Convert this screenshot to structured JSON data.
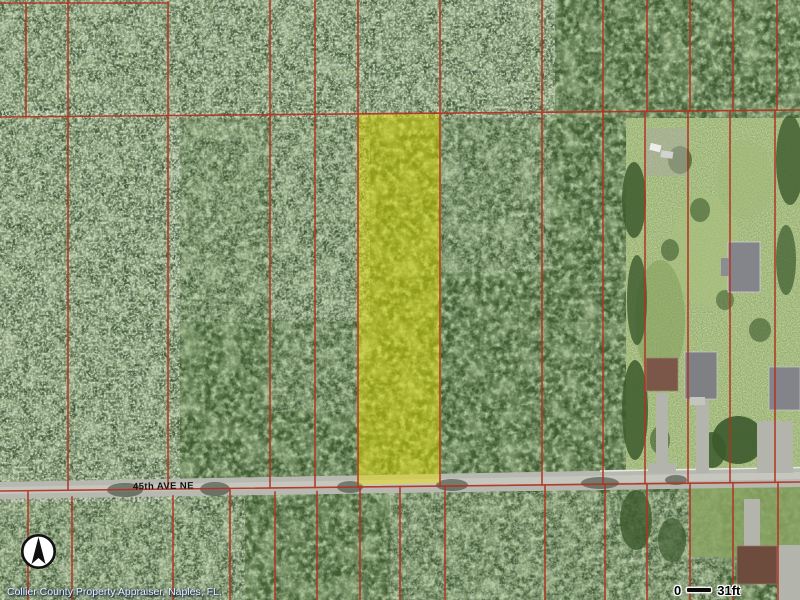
{
  "map": {
    "title": "aerial-parcel-map",
    "road_label": "45th AVE NE",
    "attribution": "Collier County Property Appraiser, Naples, FL.",
    "scale_bar": {
      "start": "0",
      "end": "31ft"
    },
    "icons": {
      "compass": "north-arrow-icon"
    },
    "colors": {
      "parcel_line": "#b23221",
      "selected_parcel_fill": "#e8e000",
      "road": "#b7b9b1"
    }
  }
}
